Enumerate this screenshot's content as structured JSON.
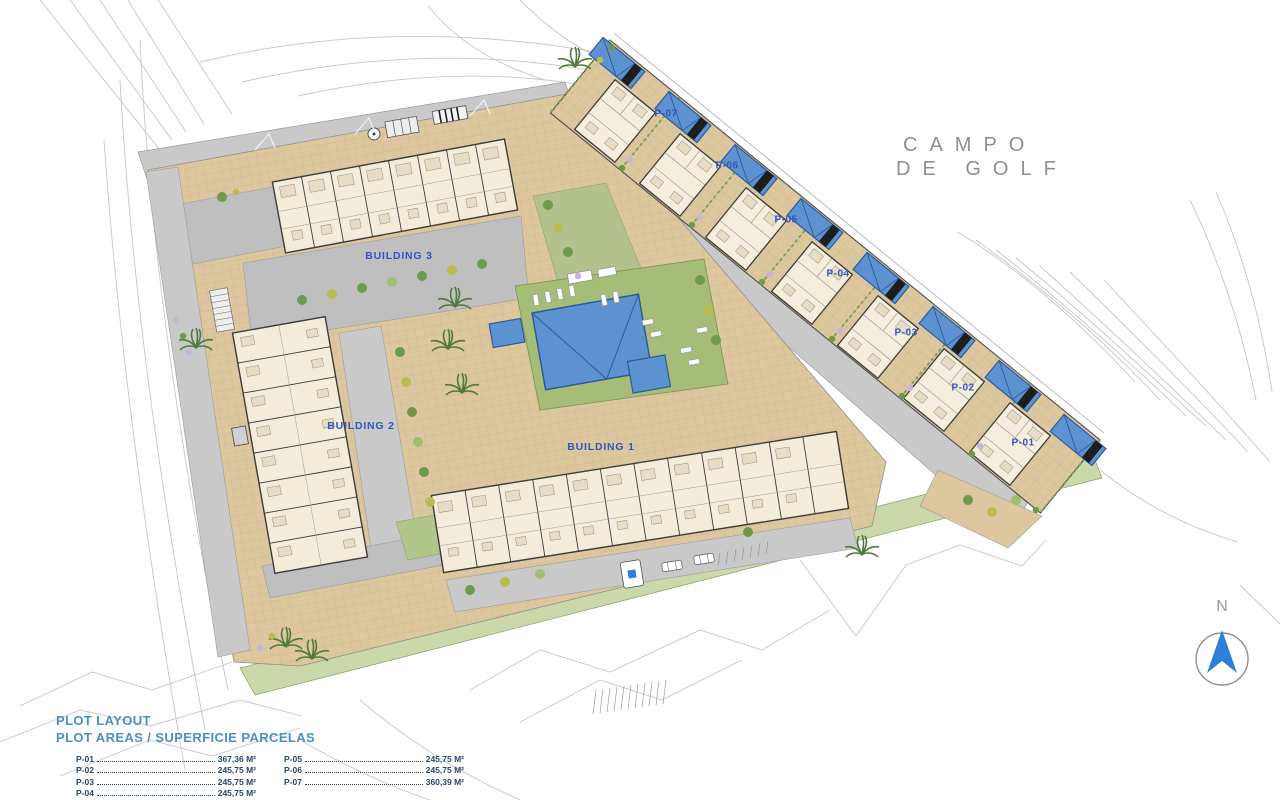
{
  "map": {
    "golf_course": {
      "line1": "CAMPO",
      "line2": "DE GOLF"
    },
    "north_label": "N",
    "buildings": [
      {
        "name": "BUILDING 1"
      },
      {
        "name": "BUILDING 2"
      },
      {
        "name": "BUILDING 3"
      }
    ],
    "plots": [
      {
        "id": "P-01"
      },
      {
        "id": "P-02"
      },
      {
        "id": "P-03"
      },
      {
        "id": "P-04"
      },
      {
        "id": "P-05"
      },
      {
        "id": "P-06"
      },
      {
        "id": "P-07"
      }
    ]
  },
  "legend": {
    "title": "PLOT LAYOUT",
    "subtitle": "PLOT AREAS / SUPERFICIE PARCELAS",
    "entries": [
      {
        "id": "P-01",
        "area": "367,36 M²"
      },
      {
        "id": "P-02",
        "area": "245,75 M²"
      },
      {
        "id": "P-03",
        "area": "245,75 M²"
      },
      {
        "id": "P-04",
        "area": "245,75 M²"
      },
      {
        "id": "P-05",
        "area": "245,75 M²"
      },
      {
        "id": "P-06",
        "area": "245,75 M²"
      },
      {
        "id": "P-07",
        "area": "360,39 M²"
      }
    ]
  },
  "colors": {
    "pool_blue": "#5d92d1",
    "paving_tan": "#dcc79f",
    "lawn_green": "#a6bd77",
    "road_gray": "#c9c9c9",
    "label_blue": "#3355c0",
    "legend_blue": "#4a90c8"
  }
}
